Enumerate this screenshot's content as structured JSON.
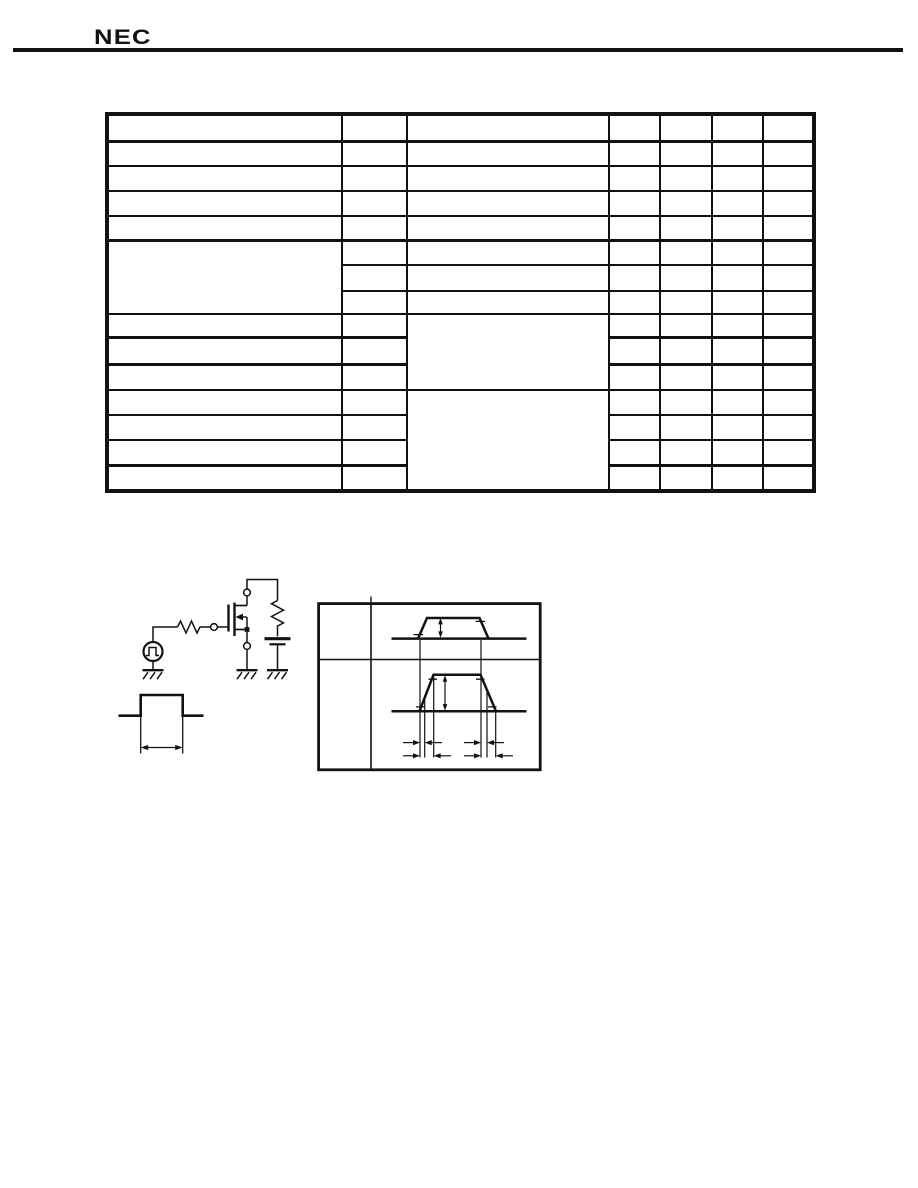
{
  "page": {
    "background": "#ffffff",
    "ink_color": "#121212",
    "kind": "datasheet page scan"
  },
  "header": {
    "logo_text": "NEC"
  },
  "spec_table": {
    "rows": 15,
    "columns": 7,
    "all_cells_blank": true,
    "merged_cells": [
      "column-1 spans rows 6-8",
      "column-3 spans rows 9-11",
      "column-3 spans rows 12-15"
    ]
  },
  "figures": {
    "test_circuit": {
      "icons": [
        "pulse-generator-icon",
        "series-resistor-icon",
        "gate-node-terminal",
        "mosfet-icon",
        "drain-terminal",
        "source-terminal",
        "load-resistor-icon",
        "battery-icon",
        "ground-icon"
      ]
    },
    "pulse_width_figure": {
      "icons": [
        "pulse-waveform",
        "pulse-width-arrow"
      ]
    },
    "timing_diagram": {
      "cells": 2,
      "icons": [
        "input-waveform",
        "output-waveform",
        "amplitude-arrow",
        "timing-guide-lines",
        "timing-measure-arrows"
      ]
    }
  }
}
